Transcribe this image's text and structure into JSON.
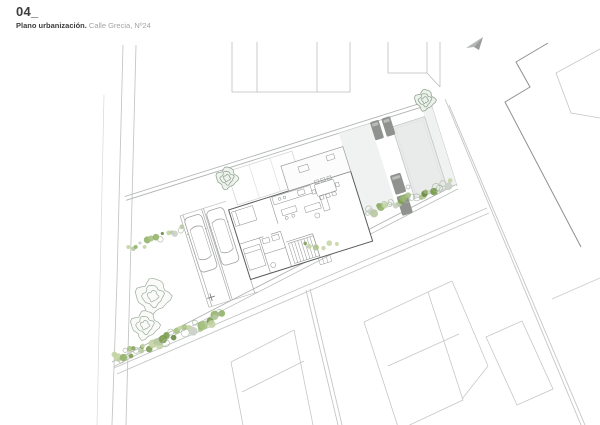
{
  "header": {
    "number": "04_",
    "title_bold": "Plano urbanización.",
    "title_light": " Calle Grecia, Nº24"
  },
  "plan": {
    "parcel_street": "Calle Grecia",
    "parcel_number": "Nº24",
    "features": [
      "house-floor-plan",
      "carport-two-cars",
      "swimming-pool",
      "sun-loungers",
      "vegetation-strips",
      "trees",
      "neighbor-parcels",
      "streets"
    ]
  },
  "colors": {
    "street_line": "#c4c7c5",
    "boundary_line": "#b2b6b4",
    "neighbor_line": "#c2c5c3",
    "dark_building_line": "#8e918f",
    "house_wall": "#5a5d5b",
    "furniture_line": "#8e918f",
    "pergola_line": "#cfd2d0",
    "parking_line": "#a9aca9",
    "pool_fill": "#e8ebea",
    "pool_stroke": "#c2c7c5",
    "terrace_fill": "#f0f2f1",
    "lounger_fill": "#8f928f",
    "lounger_pillow": "#b9bcb9",
    "tree_stroke_light": "#9bad9b",
    "tree_stroke_dark": "#879c87",
    "veg_palette": [
      "#7d9c51",
      "#94b36a",
      "#a9c283",
      "#c3d4a4",
      "#6b8a45",
      "#b7c9a0",
      "#c9cfc6"
    ]
  }
}
